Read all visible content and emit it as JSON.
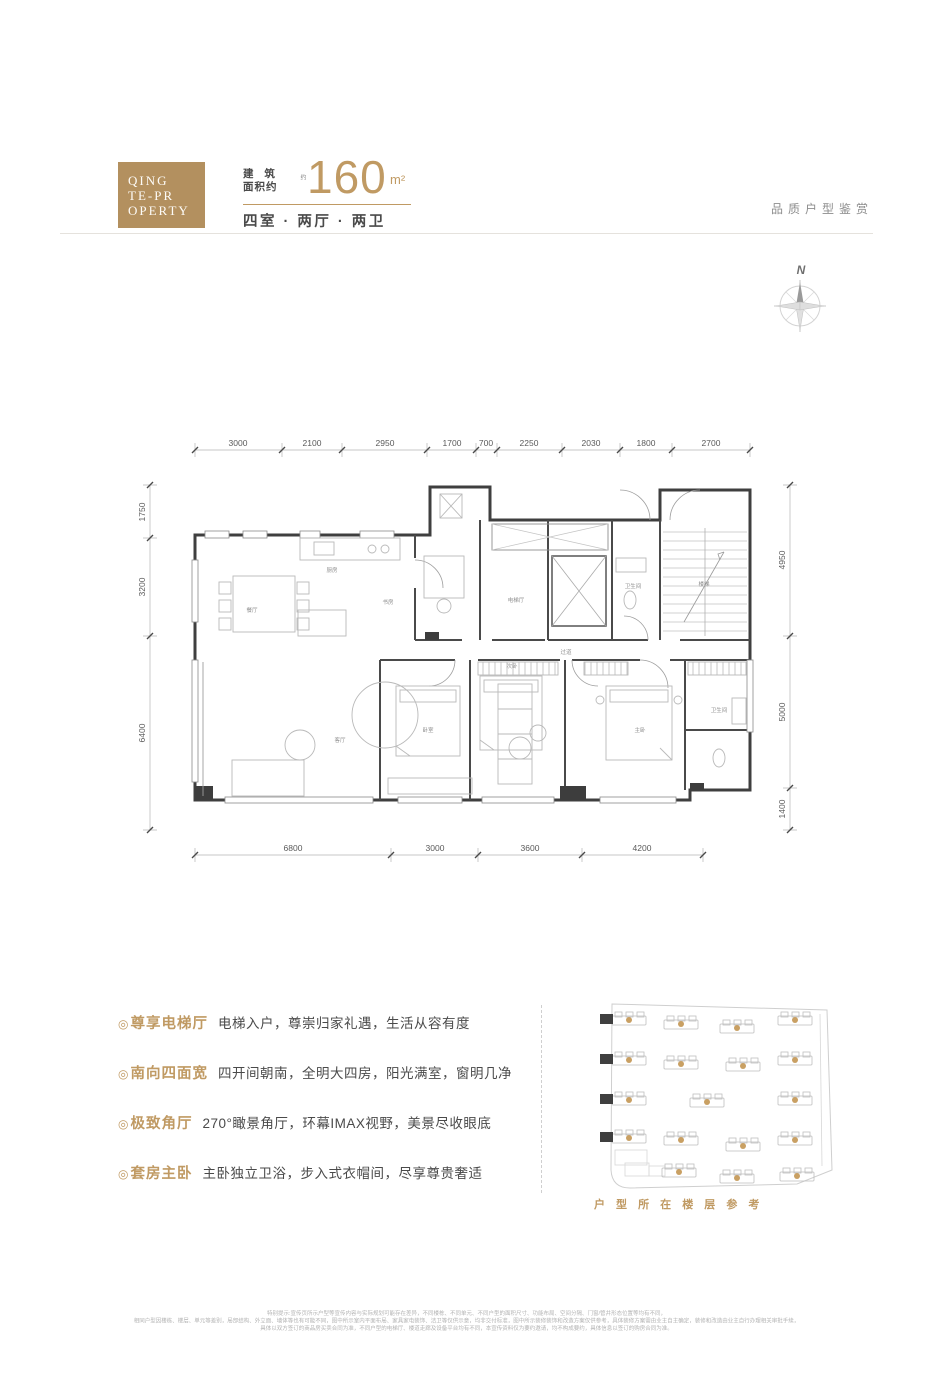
{
  "header": {
    "logo_lines": [
      "QING",
      "TE-PR",
      "OPERTY"
    ],
    "area_label_top": "建 筑",
    "area_label_bottom": "面积约",
    "area_note": "约",
    "area_value": "160",
    "area_unit": "m²",
    "layout_line": "四室 · 两厅 · 两卫",
    "right_title": "品质户型鉴赏"
  },
  "compass": {
    "label": "N"
  },
  "plan": {
    "dims": {
      "top": [
        "3000",
        "2100",
        "2950",
        "1700",
        "700",
        "2250",
        "2030",
        "1800",
        "2700"
      ],
      "left": [
        "1750",
        "3200",
        "6400"
      ],
      "right": [
        "4950",
        "5000",
        "1400"
      ],
      "bottom": [
        "6800",
        "3000",
        "3600",
        "4200"
      ]
    },
    "rooms": [
      "餐厅",
      "厨房",
      "书房",
      "电梯厅",
      "卫生间",
      "楼梯",
      "客厅",
      "卧室",
      "次卧",
      "主卧",
      "卫生间",
      "过道"
    ]
  },
  "features": {
    "bullet": "◎",
    "items": [
      {
        "title": "尊享电梯厅",
        "desc": "电梯入户，尊崇归家礼遇，生活从容有度"
      },
      {
        "title": "南向四面宽",
        "desc": "四开间朝南，全明大四房，阳光满室，窗明几净"
      },
      {
        "title": "极致角厅",
        "desc": "270°瞰景角厅，环幕IMAX视野，美景尽收眼底"
      },
      {
        "title": "套房主卧",
        "desc": "主卧独立卫浴，步入式衣帽间，尽享尊贵奢适"
      }
    ]
  },
  "site_plan": {
    "caption": "户 型 所 在 楼 层 参 考"
  },
  "footer": {
    "lines": [
      "特别提示:宣传页所示户型等宣传内容与实际规划可能存在差异，不同楼栋、不同单元、不同户型的面积尺寸、功能布局、空间分隔、门窗/管井形态位置等均有不同，",
      "相同户型因楼栋、楼层、单元等差别，局部结构、外立面、墙体等也有可能不同，图中所示室内平面布局、家具家电装饰、洁卫等仅供示意，均非交付标准，图中所示装修装饰和改造方案仅供参考，具体装修方案需由业主自主确定，装修和改造由业主自行办理相关审批手续，",
      "具体以双方签订的商品房买卖合同为准，不同户型的电梯厅、楼道走廊及设备平台均有不同，本宣传资料仅为要约邀请，均不构成要约，具体信息以签订的购房合同为准。"
    ]
  },
  "colors": {
    "logo_gold": "#b3905f",
    "accent_gold": "#c09a63",
    "text_dark": "#404040",
    "text_gray": "#9c9c9c",
    "wall": "#3f3f3f"
  }
}
